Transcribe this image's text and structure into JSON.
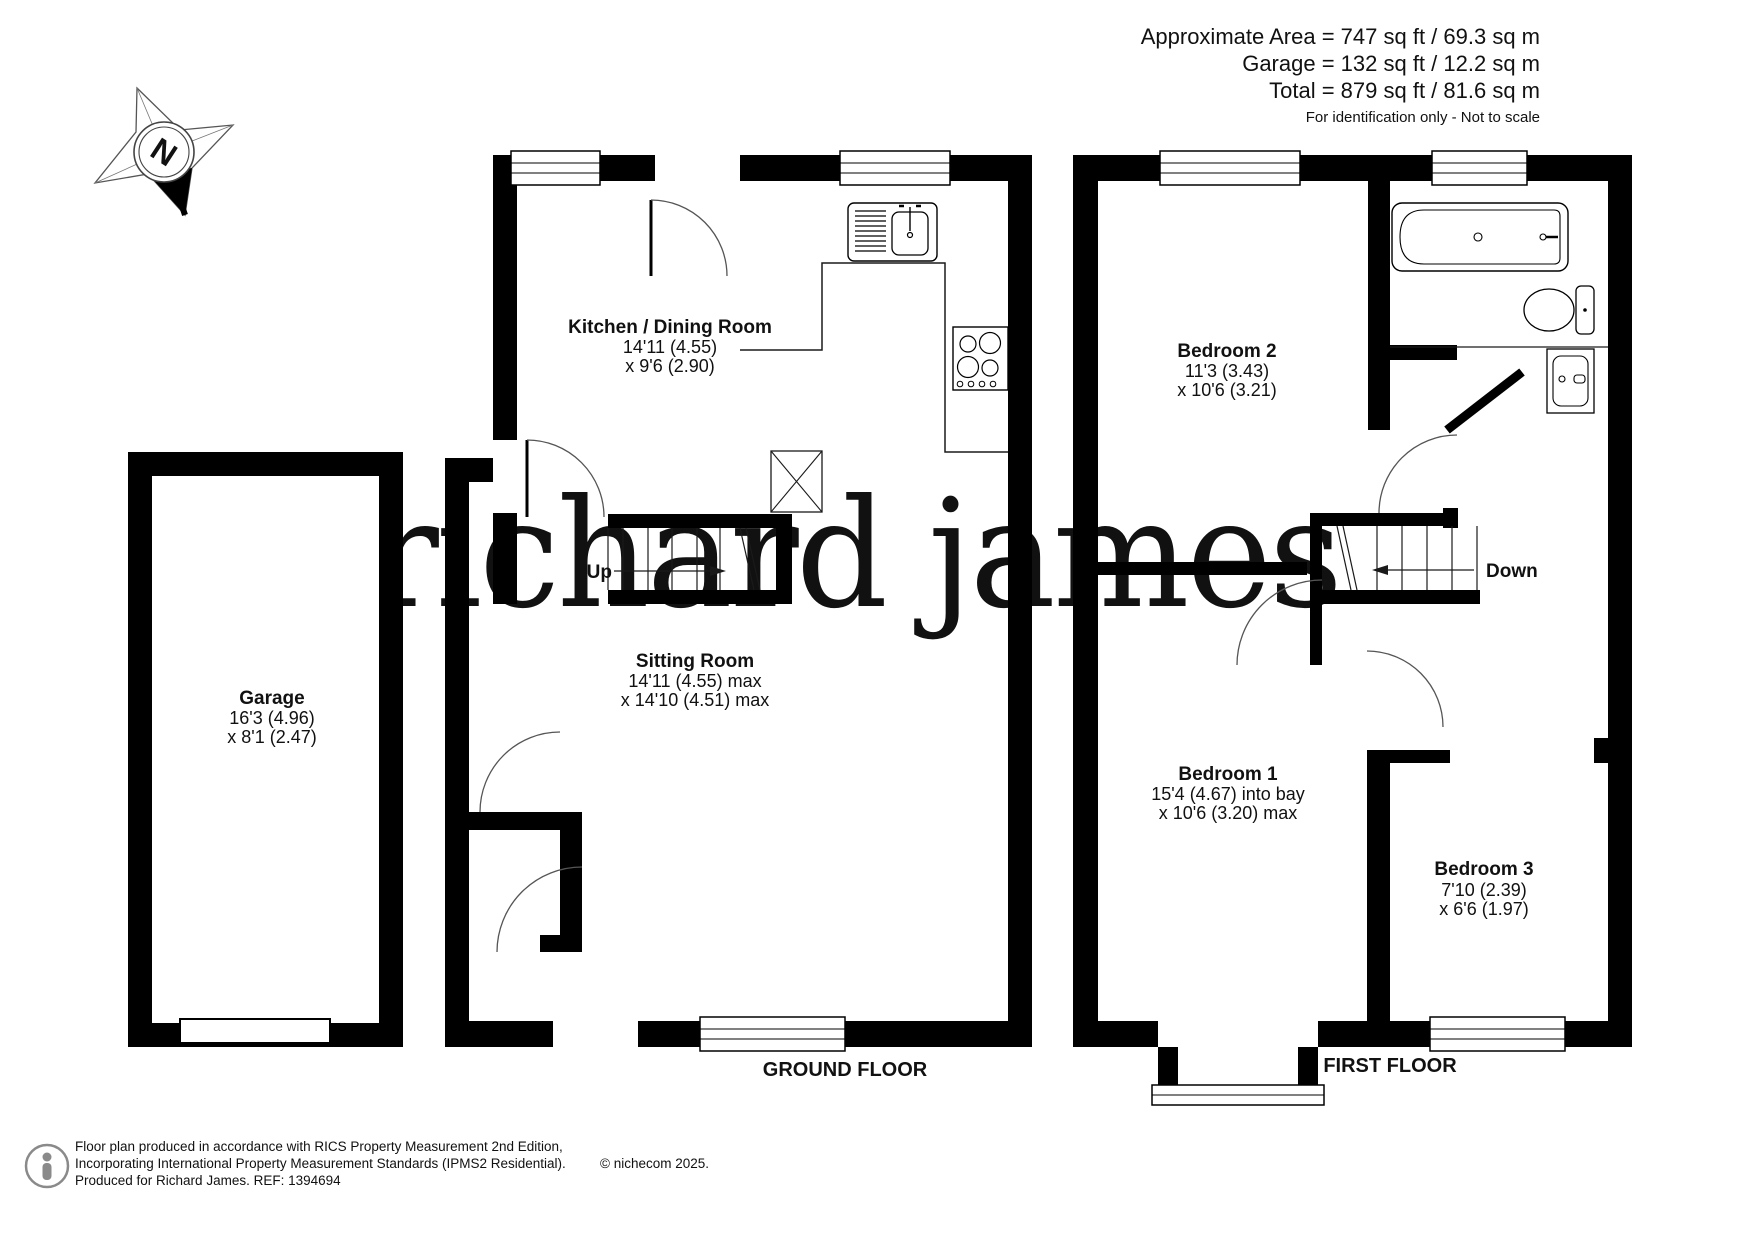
{
  "header": {
    "line1": "Approximate Area = 747 sq ft / 69.3 sq m",
    "line2": "Garage = 132 sq ft / 12.2 sq m",
    "line3": "Total = 879 sq ft / 81.6 sq m",
    "note": "For identification only - Not to scale"
  },
  "compass": {
    "label": "N"
  },
  "watermark": {
    "text": "richard james",
    "color": "#f1e2c1"
  },
  "rooms": [
    {
      "name": "Kitchen / Dining Room",
      "dim1": "14'11 (4.55)",
      "dim2": "x 9'6 (2.90)"
    },
    {
      "name": "Garage",
      "dim1": "16'3 (4.96)",
      "dim2": "x 8'1 (2.47)"
    },
    {
      "name": "Sitting Room",
      "dim1": "14'11 (4.55) max",
      "dim2": "x 14'10 (4.51) max"
    },
    {
      "name": "Bedroom 2",
      "dim1": "11'3 (3.43)",
      "dim2": "x 10'6 (3.21)"
    },
    {
      "name": "Bedroom 1",
      "dim1": "15'4 (4.67) into bay",
      "dim2": "x 10'6 (3.20) max"
    },
    {
      "name": "Bedroom 3",
      "dim1": "7'10 (2.39)",
      "dim2": "x 6'6 (1.97)"
    }
  ],
  "stairs": {
    "up_label": "Up",
    "down_label": "Down"
  },
  "floor_labels": {
    "ground": "GROUND FLOOR",
    "first": "FIRST FLOOR"
  },
  "footer": {
    "line1": "Floor plan produced in accordance with RICS Property Measurement 2nd Edition,",
    "line2": "Incorporating International Property Measurement Standards (IPMS2 Residential).",
    "copyright": "© nichecom 2025.",
    "line3": "Produced for Richard James.   REF:  1394694"
  },
  "colors": {
    "wall": "#000000",
    "thin_line": "#1a1a1a",
    "arc": "#555555",
    "footer_text": "#3c3c3c"
  }
}
